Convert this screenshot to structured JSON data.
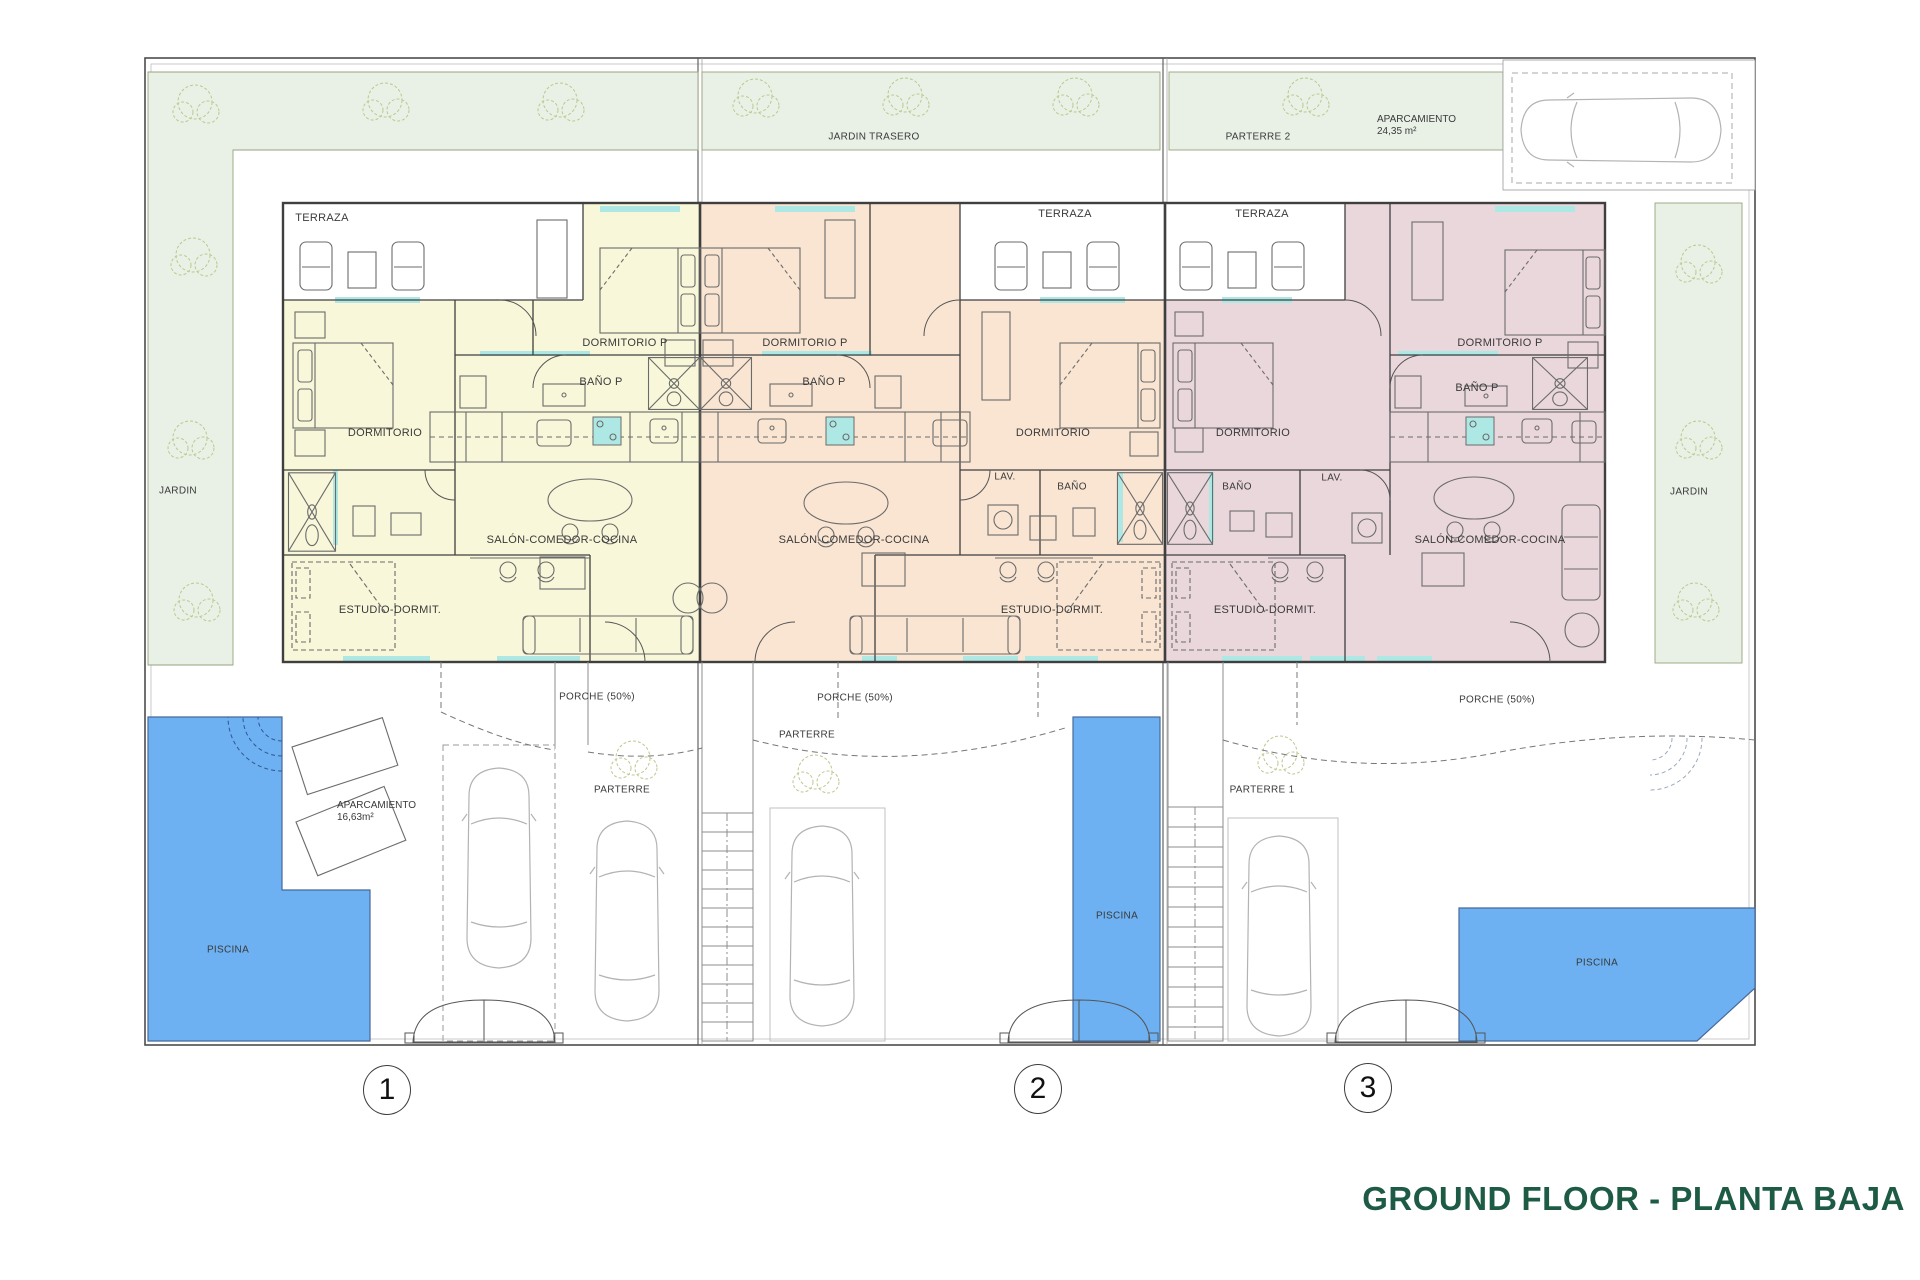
{
  "title": "GROUND FLOOR - PLANTA BAJA",
  "site": {
    "jardin_trasero": "JARDIN TRASERO",
    "parterre_2": "PARTERRE 2",
    "jardin_left": "JARDIN",
    "jardin_right": "JARDIN",
    "parking_top": {
      "label": "APARCAMIENTO",
      "area": "24,35 m²"
    }
  },
  "units": [
    {
      "number": "1",
      "rooms": {
        "terraza": "TERRAZA",
        "dormitorio_p": "DORMITORIO P",
        "bano_p": "BAÑO P",
        "dormitorio": "DORMITORIO",
        "salon": "SALÓN-COMEDOR-COCINA",
        "estudio": "ESTUDIO-DORMIT."
      },
      "outdoor": {
        "porche": "PORCHE (50%)",
        "parterre": "PARTERRE",
        "piscina": "PISCINA",
        "parking": {
          "label": "APARCAMIENTO",
          "area": "16,63m²"
        }
      }
    },
    {
      "number": "2",
      "rooms": {
        "terraza": "TERRAZA",
        "dormitorio_p": "DORMITORIO P",
        "bano_p": "BAÑO P",
        "dormitorio": "DORMITORIO",
        "lav": "LAV.",
        "bano": "BAÑO",
        "salon": "SALÓN-COMEDOR-COCINA",
        "estudio": "ESTUDIO-DORMIT."
      },
      "outdoor": {
        "porche": "PORCHE (50%)",
        "parterre": "PARTERRE",
        "piscina": "PISCINA"
      }
    },
    {
      "number": "3",
      "rooms": {
        "terraza": "TERRAZA",
        "dormitorio_p": "DORMITORIO P",
        "bano_p": "BAÑO P",
        "dormitorio": "DORMITORIO",
        "lav": "LAV.",
        "bano": "BAÑO",
        "salon": "SALÓN-COMEDOR-COCINA",
        "estudio": "ESTUDIO-DORMIT."
      },
      "outdoor": {
        "porche": "PORCHE (50%)",
        "parterre": "PARTERRE 1",
        "piscina": "PISCINA"
      }
    }
  ],
  "colors": {
    "unit1": "#f8f7d9",
    "unit2": "#f9e5d2",
    "unit3": "#ead7dc",
    "garden": "#e9f1e6",
    "pool": "#6db1f2",
    "window": "#aee8e4",
    "title": "#1e5b44"
  }
}
